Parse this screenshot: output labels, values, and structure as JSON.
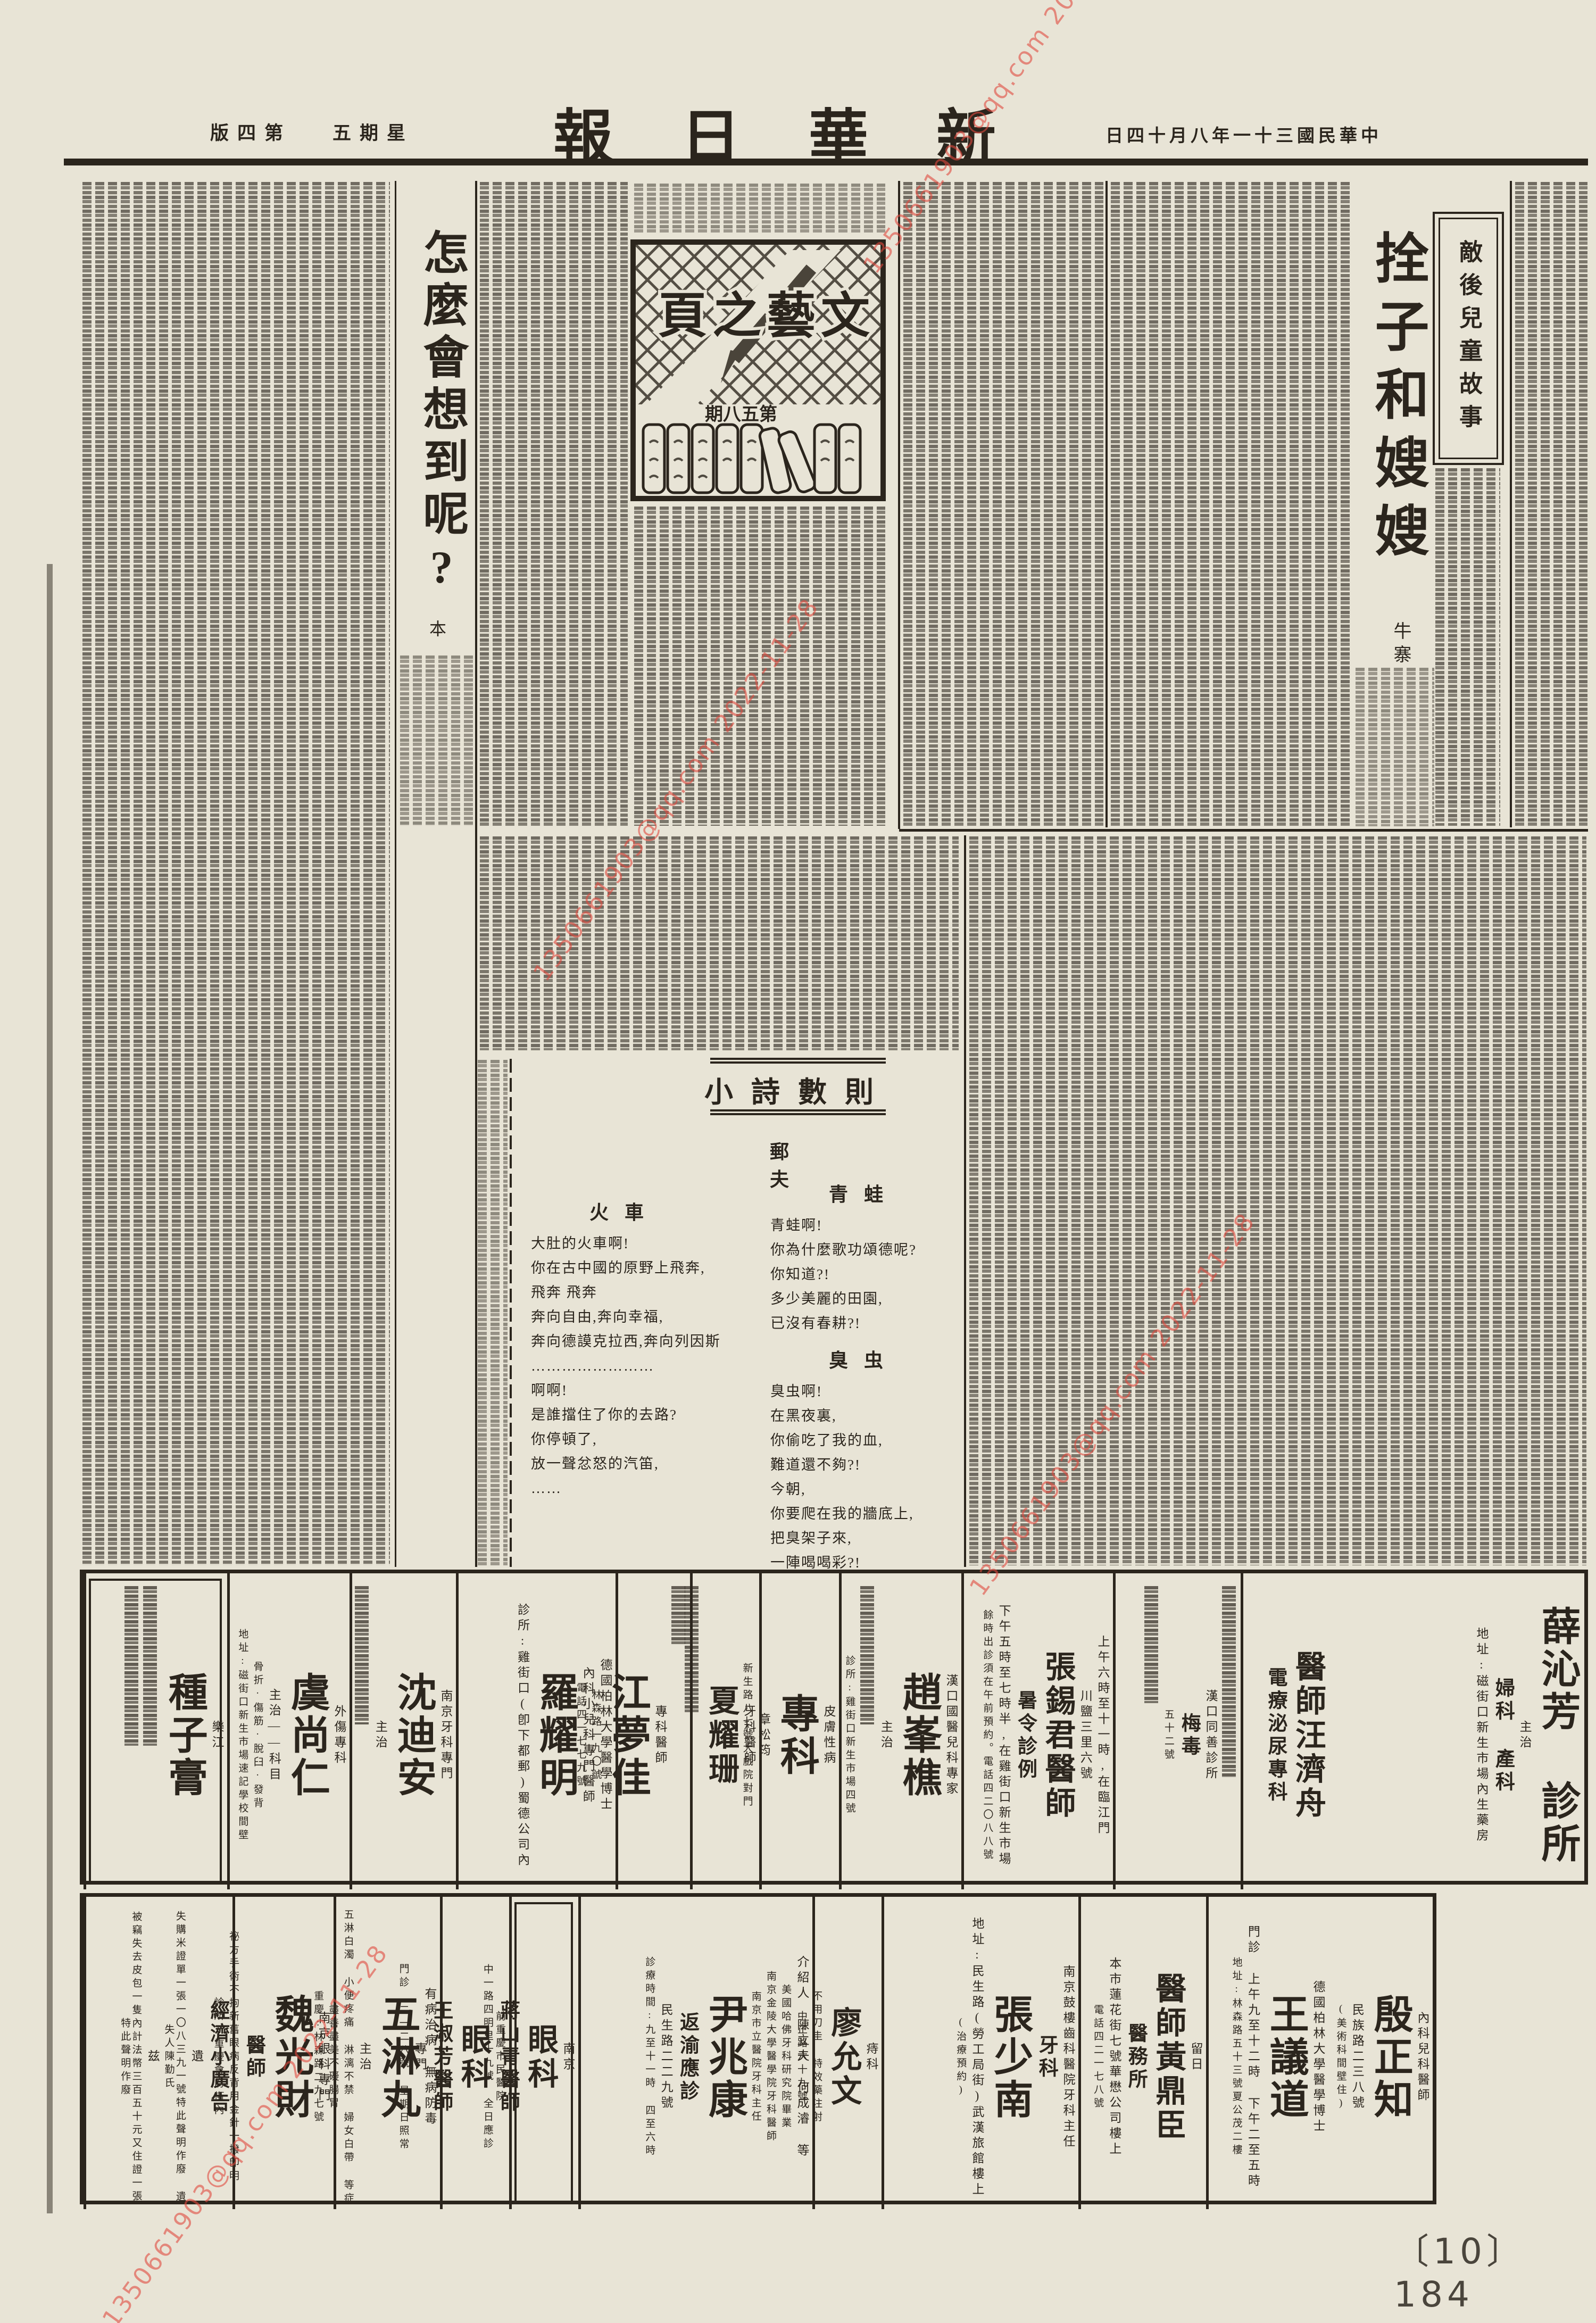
{
  "header": {
    "edition_display": "版四第",
    "weekday_display": "五期星",
    "masthead_display": "報日華新",
    "date_display": "日四十月八年一十三國民華中"
  },
  "literary_page": {
    "title_display": "頁之藝文",
    "issue_display": "期八五第"
  },
  "story_right": {
    "series_box": "敵後兒童故事",
    "title": "拴子和嫂嫂",
    "author": "牛寨"
  },
  "story_left": {
    "title": "怎麼會想到呢?",
    "author": "本"
  },
  "poems": {
    "section_title": "小詩數則",
    "author_display": "郵 夫",
    "items": [
      {
        "title": "青蛙",
        "lines": [
          "青蛙啊!",
          "你為什麼歌功頌德呢?",
          "你知道?!",
          "多少美麗的田園,",
          "已沒有春耕?!"
        ]
      },
      {
        "title": "臭虫",
        "lines": [
          "臭虫啊!",
          "在黑夜裏,",
          "你偷吃了我的血,",
          "難道還不夠?!",
          "今朝,",
          "你要爬在我的牆底上,",
          "把臭架子來,",
          "一陣喝喝彩?!"
        ]
      },
      {
        "title": "火車",
        "lines": [
          "大肚的火車啊!",
          "你在古中國的原野上飛奔,",
          "飛奔  飛奔",
          "奔向自由,奔向幸福,",
          "奔向德謨克拉西,奔向列因斯",
          "……………………",
          "啊啊!",
          "是誰擋住了你的去路?",
          "你停頓了,",
          "放一聲忿怒的汽笛,",
          "……"
        ]
      }
    ]
  },
  "ads_row1": {
    "cells": [
      {
        "name": "薛沁芳診所",
        "lines": [
          {
            "c": "xl",
            "t": "薛沁芳 診所"
          },
          {
            "c": "sm",
            "t": "主治"
          },
          {
            "c": "md",
            "t": "婦科 產科"
          },
          {
            "c": "sm",
            "t": "地址:磁街口新生市場內生藥房"
          }
        ]
      },
      {
        "name": "醫師汪濟舟",
        "lines": [
          {
            "c": "lg",
            "t": "醫師汪濟舟"
          },
          {
            "c": "md",
            "t": "電療泌尿專科"
          }
        ]
      },
      {
        "name": "漢口同善診所",
        "lines": [
          {
            "strip": 360
          },
          {
            "c": "sm",
            "t": "漢口同善診所"
          },
          {
            "c": "md",
            "t": "梅毒"
          },
          {
            "c": "xs",
            "t": "五十二號"
          },
          {
            "strip": 220
          }
        ]
      },
      {
        "name": "張錫君醫師暑令診例",
        "lines": [
          {
            "c": "sm",
            "t": "上午六時至十一時,在臨江門"
          },
          {
            "c": "sm",
            "t": "川鹽三里六號"
          },
          {
            "c": "lg",
            "t": "張錫君醫師"
          },
          {
            "c": "md",
            "t": "暑令診例"
          },
          {
            "c": "sm",
            "t": "下午五時至七時半,在雞街口新生市場"
          },
          {
            "c": "xs",
            "t": "餘時出診須在午前預約。電話四二〇八八號"
          }
        ]
      },
      {
        "name": "趙峯樵",
        "lines": [
          {
            "c": "sm",
            "t": "漢口國醫兒科專家"
          },
          {
            "c": "xl",
            "t": "趙峯樵"
          },
          {
            "c": "sm",
            "t": "主治"
          },
          {
            "strip": 260
          },
          {
            "c": "xs",
            "t": "診所:雞街口新生市場四號"
          }
        ]
      },
      {
        "name": "皮膚性病專科章松筠",
        "lines": [
          {
            "c": "sm",
            "t": "皮膚性病"
          },
          {
            "c": "xl",
            "t": "專科"
          },
          {
            "c": "sm",
            "t": "章松筠"
          },
          {
            "c": "xs",
            "t": "新生路八七號大戲院對門"
          }
        ]
      },
      {
        "name": "夏耀珊",
        "lines": [
          {
            "c": "sm",
            "t": "牙科醫師"
          },
          {
            "c": "lg",
            "t": "夏耀珊"
          },
          {
            "strip": 240
          }
        ]
      },
      {
        "name": "江夢佳",
        "lines": [
          {
            "strip": 110
          },
          {
            "c": "sm",
            "t": "專科醫師"
          },
          {
            "c": "xl",
            "t": "江夢佳"
          },
          {
            "c": "xs",
            "t": "林森路一九〇號"
          },
          {
            "c": "xs",
            "t": "電話四一七七九號"
          }
        ]
      },
      {
        "name": "羅耀明",
        "lines": [
          {
            "c": "sm",
            "t": "德國柏林大學醫學博士"
          },
          {
            "c": "sm",
            "t": "內科小兒科專門醫師"
          },
          {
            "c": "xl",
            "t": "羅耀明"
          },
          {
            "c": "sm",
            "t": "診所:雞街口(卽下都郵)蜀德公司內"
          }
        ]
      },
      {
        "name": "沈迪安",
        "lines": [
          {
            "c": "sm",
            "t": "南京牙科專門"
          },
          {
            "c": "xl",
            "t": "沈迪安"
          },
          {
            "c": "sm",
            "t": "主治"
          },
          {
            "strip": 260
          }
        ]
      },
      {
        "name": "虞尚仁",
        "lines": [
          {
            "c": "sm",
            "t": "外傷專科"
          },
          {
            "c": "xl",
            "t": "虞尚仁"
          },
          {
            "c": "sm",
            "t": "主治——科目"
          },
          {
            "c": "xs",
            "t": "骨折·傷筋·脫臼·發背"
          },
          {
            "c": "xs",
            "t": "地址:磁街口新生市場速記學校間壁"
          }
        ]
      },
      {
        "name": "種子膏",
        "lines": [
          {
            "c": "sm",
            "t": "樂江"
          },
          {
            "c": "xl",
            "t": "種子膏"
          },
          {
            "strip": 300
          },
          {
            "strip": 300
          }
        ]
      }
    ]
  },
  "ads_row2": {
    "cells": [
      {
        "name": "殷正知",
        "lines": [
          {
            "c": "sm",
            "t": "內科兒科醫師"
          },
          {
            "c": "xl",
            "t": "殷正知"
          },
          {
            "c": "sm",
            "t": "民族路二三八號"
          },
          {
            "c": "xs",
            "t": "(美術科間壁住)"
          }
        ]
      },
      {
        "name": "王議道",
        "lines": [
          {
            "c": "sm",
            "t": "德國柏林大學醫學博士"
          },
          {
            "c": "xl",
            "t": "王議道"
          },
          {
            "c": "sm",
            "t": "門診 上午九至十二時 下午二至五時"
          },
          {
            "c": "xs",
            "t": "地址:林森路五十三號夏公茂二樓"
          }
        ]
      },
      {
        "name": "醫師黃鼎臣",
        "lines": [
          {
            "c": "sm",
            "t": "留日"
          },
          {
            "c": "lg",
            "t": "醫師黃鼎臣"
          },
          {
            "c": "md",
            "t": "醫務所"
          },
          {
            "c": "sm",
            "t": "本市蓮花街七號華懋公司樓上"
          },
          {
            "c": "xs",
            "t": "電話四二一七八號"
          }
        ]
      },
      {
        "name": "牙科張少南",
        "lines": [
          {
            "c": "sm",
            "t": "南京鼓樓齒科醫院牙科主任"
          },
          {
            "c": "md",
            "t": "牙科"
          },
          {
            "c": "xl",
            "t": "張少南"
          },
          {
            "c": "sm",
            "t": "地址:民生路(勞工局街)武漢旅館樓上"
          },
          {
            "c": "xs",
            "t": "(治療預約)"
          }
        ]
      },
      {
        "name": "痔科廖允文",
        "lines": [
          {
            "c": "sm",
            "t": "痔科"
          },
          {
            "c": "lg",
            "t": "廖允文"
          },
          {
            "c": "xs",
            "t": "不用刀圭 特效藥注射"
          },
          {
            "c": "xs",
            "t": "中正路六十九號"
          }
        ]
      },
      {
        "name": "尹兆康",
        "lines": [
          {
            "c": "sm",
            "t": "介紹人 陳立夫 何成濬 等"
          },
          {
            "c": "xs",
            "t": "美國哈佛牙科研究院畢業"
          },
          {
            "c": "xs",
            "t": "南京金陵大學醫學院牙科醫師"
          },
          {
            "c": "xs",
            "t": "南京市立醫院牙科主任"
          },
          {
            "c": "xl",
            "t": "尹兆康"
          },
          {
            "c": "md",
            "t": "返渝應診"
          },
          {
            "c": "sm",
            "t": "民生路二二九號"
          },
          {
            "c": "xs",
            "t": "診療時間:九至十一時 四至六時"
          }
        ]
      },
      {
        "name": "眼科蔣山青",
        "lines": [
          {
            "c": "sm",
            "t": "南京"
          },
          {
            "c": "lg",
            "t": "眼科"
          },
          {
            "c": "md",
            "t": "蔣山青醫師"
          },
          {
            "c": "xs",
            "t": "中一路四明里十九號 全日應診"
          }
        ]
      },
      {
        "name": "眼科王淑芳",
        "lines": [
          {
            "c": "xs",
            "t": "前重慶市民醫院"
          },
          {
            "c": "lg",
            "t": "眼科"
          },
          {
            "c": "md",
            "t": "王淑芳醫師"
          },
          {
            "c": "sm",
            "t": "專門"
          },
          {
            "c": "xs",
            "t": "門診 二一二八號 星期日照常"
          }
        ]
      },
      {
        "name": "五淋丸",
        "lines": [
          {
            "c": "sm",
            "t": "有病治病 無病防毒"
          },
          {
            "c": "xl",
            "t": "五淋丸"
          },
          {
            "c": "sm",
            "t": "主治"
          },
          {
            "c": "xs",
            "t": "五淋白濁 小便疼痛 淋漓不禁 婦女白帶 等症"
          },
          {
            "c": "xs",
            "t": "盡善盡美不礙腸胃"
          },
          {
            "c": "xs",
            "t": "重慶:林森路二九七號"
          }
        ]
      },
      {
        "name": "眼科魏光財",
        "lines": [
          {
            "c": "sm",
            "t": "南京眼科專門"
          },
          {
            "c": "xl",
            "t": "魏光財"
          },
          {
            "c": "md",
            "t": "醫師"
          },
          {
            "c": "xs",
            "t": "祕方手術不拘新舊眼病反背用金針一撥卽明"
          },
          {
            "c": "xs",
            "t": "診所:重慶會府街內"
          }
        ]
      },
      {
        "name": "經濟小廣告",
        "lines": [
          {
            "c": "md",
            "t": "經濟小廣告"
          },
          {
            "c": "sm",
            "t": "遺"
          },
          {
            "c": "xs",
            "t": "失購米證單一張一〇八三九一號特此聲明作廢 遺失人陳勤氏"
          },
          {
            "c": "sm",
            "t": "兹"
          },
          {
            "c": "xs",
            "t": "被竊失去皮包一隻內計法幣三百五十元又住證一張 特此聲明作廢"
          }
        ]
      }
    ]
  },
  "footer": {
    "page_number": "〔10〕 184"
  },
  "watermark": {
    "text": "1350661903@qq.com 2022-11-28",
    "color": "#e04a3e"
  }
}
